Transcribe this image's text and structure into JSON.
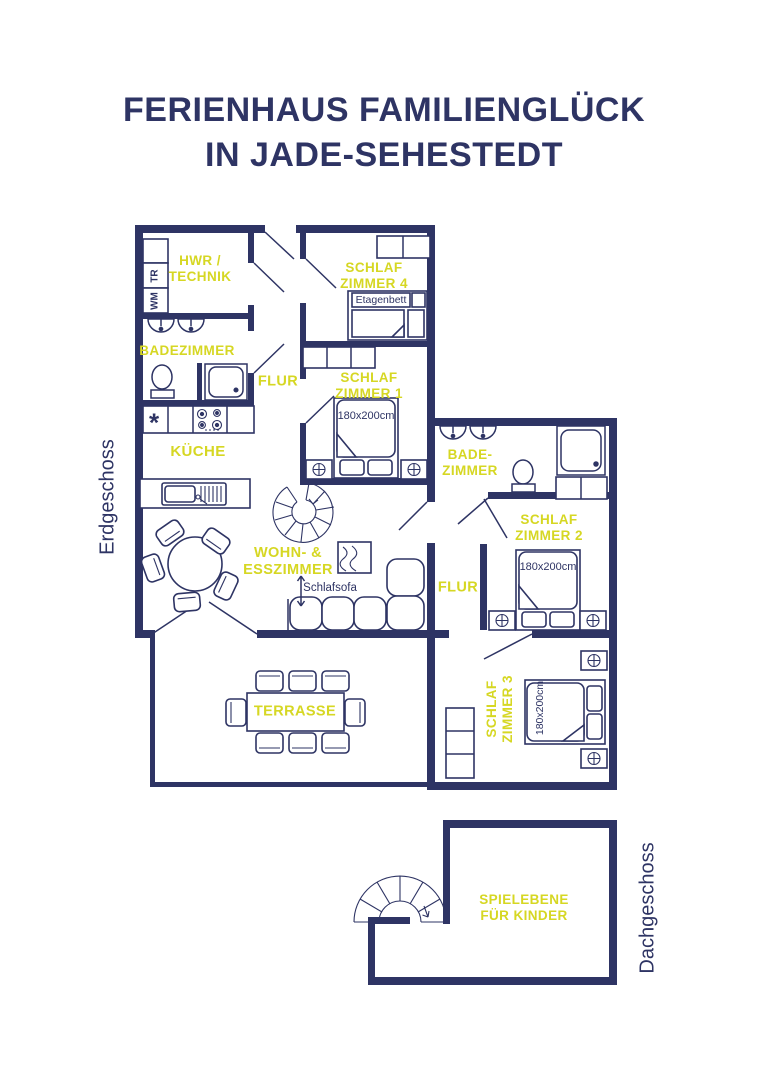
{
  "title": {
    "line1": "FERIENHAUS FAMILIENGLÜCK",
    "line2": "IN JADE-SEHESTEDT"
  },
  "colors": {
    "navy": "#2e3464",
    "yellow": "#d6d723",
    "background": "#ffffff"
  },
  "floor_labels": {
    "ground": "Erdgeschoss",
    "attic": "Dachgeschoss"
  },
  "rooms": {
    "hwr": "HWR /\nTECHNIK",
    "badezimmer1": "BADEZIMMER",
    "flur1": "FLUR",
    "schlafzimmer4": "SCHLAF\nZIMMER 4",
    "schlafzimmer1": "SCHLAF\nZIMMER 1",
    "kueche": "KÜCHE",
    "badezimmer2": "BADE-\nZIMMER",
    "schlafzimmer2": "SCHLAF\nZIMMER 2",
    "wohnesszimmer": "WOHN- &\nESSZIMMER",
    "flur2": "FLUR",
    "terrasse": "TERRASSE",
    "schlafzimmer3": "SCHLAF\nZIMMER 3",
    "spielebene": "SPIELEBENE\nFÜR KINDER"
  },
  "annotations": {
    "etagenbett": "Etagenbett",
    "schlafsofa": "Schlafsofa",
    "bed_size": "180x200cm",
    "washer": "WM",
    "dryer": "TR",
    "freezer_symbol": "*"
  }
}
